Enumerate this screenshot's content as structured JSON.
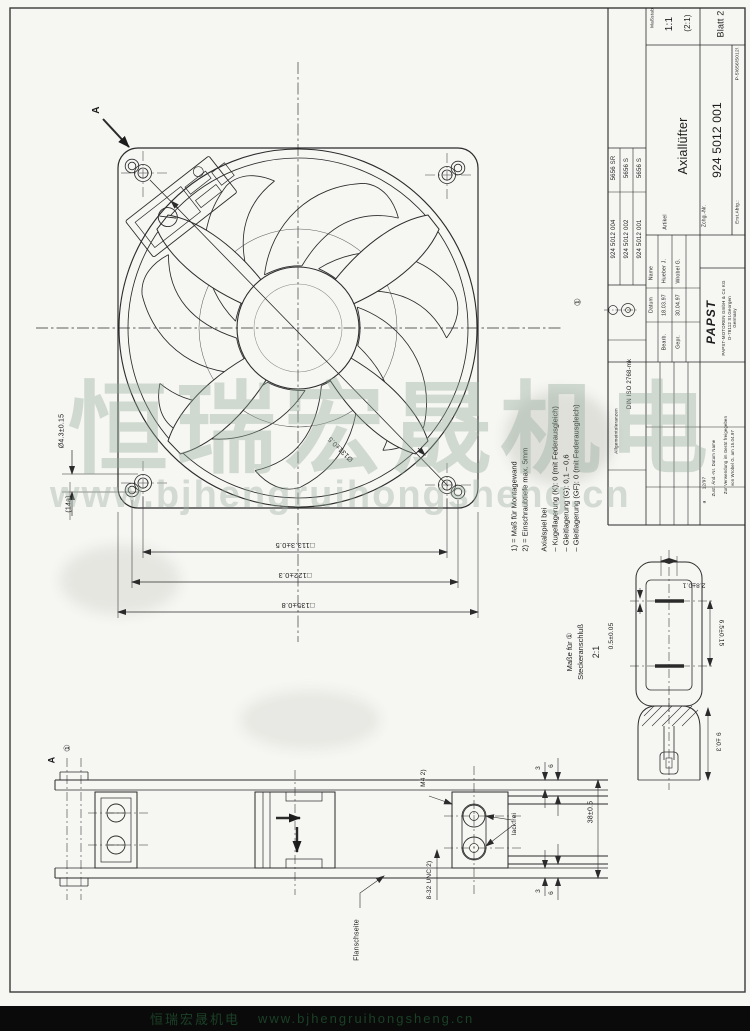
{
  "watermark": {
    "line1": "恒瑞宏晟机电",
    "line2": "www.bjhengruihongsheng.cn"
  },
  "front_view": {
    "view_label": "A",
    "diag_dim": "Ø131±0.5",
    "dim_inner": "□113.3±0.5",
    "dim_mid": "□122±0.3",
    "dim_outer": "□135±0.8",
    "hole_dim": "Ø4.3±0.15",
    "ref_dim": "(14a)"
  },
  "side_view": {
    "view_label": "A",
    "note_ref": "①",
    "thread_m4": "M4 2)",
    "thread_unc": "8-32 UNC 2)",
    "flange_label": "Flanschseite",
    "paintfree_label": "lackfrei",
    "depth_dim": "38±0.5",
    "d3": "3",
    "d6": "6"
  },
  "detail": {
    "title_line1": "Maße für ①",
    "title_line2": "Steckeranschluß",
    "scale": "2:1",
    "dim_width": "2.8±0.1",
    "dim_thickness": "0.5±0.05",
    "dim_spacing": "6.5±0.15",
    "dim_height": "9 ±0.3"
  },
  "notes": {
    "ref": "①",
    "n1": "1) = Maß für Montagewand",
    "n2": "2) = Einschraubtiefe max. 5mm",
    "axial_title": "Axialspiel bei",
    "b1": "– Kugellagerung  (K):  0  (mit Federausgleich)",
    "b2": "– Gleitlagerung  (G):  0,1 – 0,6",
    "b3": "– Gleitlagerung  (GF): 0  (mit Federausgleich)"
  },
  "title_block": {
    "scale_label": "Maßstab",
    "scale_main": "1:1",
    "scale_alt": "(2:1)",
    "sheet": "Blatt 2",
    "article_label": "Artikel",
    "article": "Axiallüfter",
    "drawing_label": "Zchg.-Nr.",
    "drawing_no": "924 5012 001",
    "dept_label": "Erst.Abtg.:",
    "dept_value": "P-5\\656\\5012\\",
    "tol_label": "Allgemeintoleranzen",
    "tol_value": "DIN ISO 2768-mk",
    "sign": {
      "datum": "Datum",
      "name": "Name",
      "row1_role": "Bearb.",
      "row1_date": "18.03.97",
      "row1_name": "Hueber J.",
      "row2_role": "Gepr.",
      "row2_date": "30.04.97",
      "row2_name": "Wrobel G."
    },
    "company": {
      "logo": "PAPST",
      "l1": "PAPST-MOTOREN GmbH & Co KG",
      "l2": "D-78112 St.Georgen",
      "l3": "Germany"
    },
    "variants": [
      {
        "pn": "924 5012 004",
        "type": "5656 SR"
      },
      {
        "pn": "924 5012 002",
        "type": "5656 S"
      },
      {
        "pn": "924 5012 001",
        "type": "5656 S"
      }
    ],
    "rev": {
      "zust": "a",
      "aend": "12/97",
      "cols": "Zust.  Änd.-Nr.  Datum  Name",
      "note1": "Zur Verwendung im Gerät freigegeben",
      "note2": "von Wrobel G. am 15.04.97"
    }
  }
}
